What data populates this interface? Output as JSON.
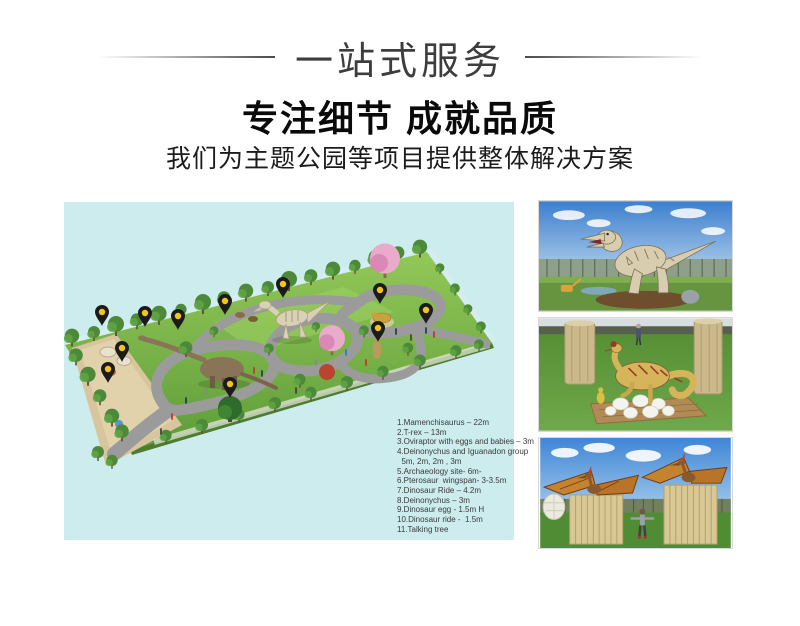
{
  "header": {
    "banner_title": "一站式服务",
    "headline": "专注细节 成就品质",
    "subheadline": "我们为主题公园等项目提供整体解决方案"
  },
  "park_plan": {
    "panel_bg": "#cdecee",
    "pin_count": 11,
    "pin_color": "#f2c51d",
    "legend_items": [
      "1.Mamenchisaurus – 22m",
      "2.T-rex – 13m",
      "3.Oviraptor with eggs and babies – 3m",
      "4.Deinonychus and Iguanadon group",
      "  5m, 2m, 2m , 3m",
      "5.Archaeology site- 6m-",
      "6.Pterosaur  wingspan- 3-3.5m",
      "7.Dinosaur Ride – 4.2m",
      "8.Deinonychus – 3m",
      "9.Dinosaur egg - 1.5m H",
      "10.Dinosaur ride -  1.5m",
      "11.Talking tree"
    ]
  },
  "photos": {
    "items": [
      {
        "name": "animatronic-t-rex"
      },
      {
        "name": "oviraptor-with-eggs-and-baby"
      },
      {
        "name": "pterosaurs-on-wooden-crates"
      }
    ]
  }
}
